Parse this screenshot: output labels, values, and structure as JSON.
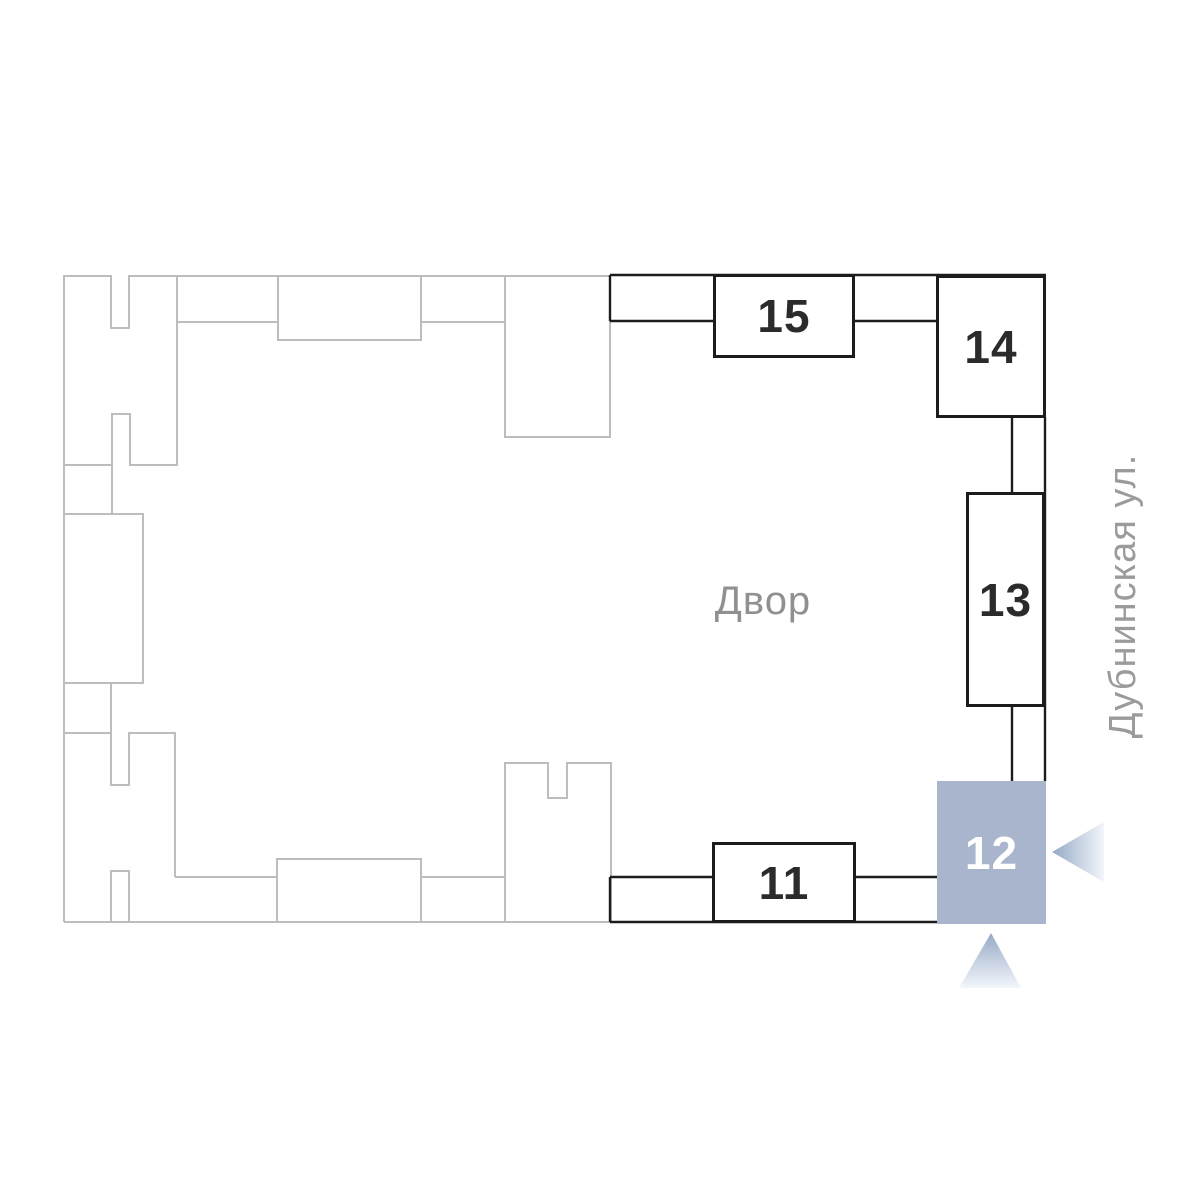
{
  "plan": {
    "courtyard_label": "Двор",
    "street_label": "Дубнинская ул.",
    "buildings": [
      {
        "number": "15",
        "state": "available"
      },
      {
        "number": "14",
        "state": "available"
      },
      {
        "number": "13",
        "state": "available"
      },
      {
        "number": "12",
        "state": "selected"
      },
      {
        "number": "11",
        "state": "available"
      }
    ],
    "markers": [
      {
        "name": "selected-building-arrow-left",
        "direction": "left"
      },
      {
        "name": "selected-building-arrow-up",
        "direction": "up"
      }
    ],
    "colors": {
      "selected_fill": "#a8b5cd",
      "selected_text": "#ffffff",
      "active_outline": "#1c1c1c",
      "inactive_outline": "#bdbdbd",
      "courtyard_text": "#909090",
      "street_text": "#9b9b9b",
      "arrow_gradient_start": "#96a9c5",
      "arrow_gradient_end": "#f3f6fb"
    }
  }
}
